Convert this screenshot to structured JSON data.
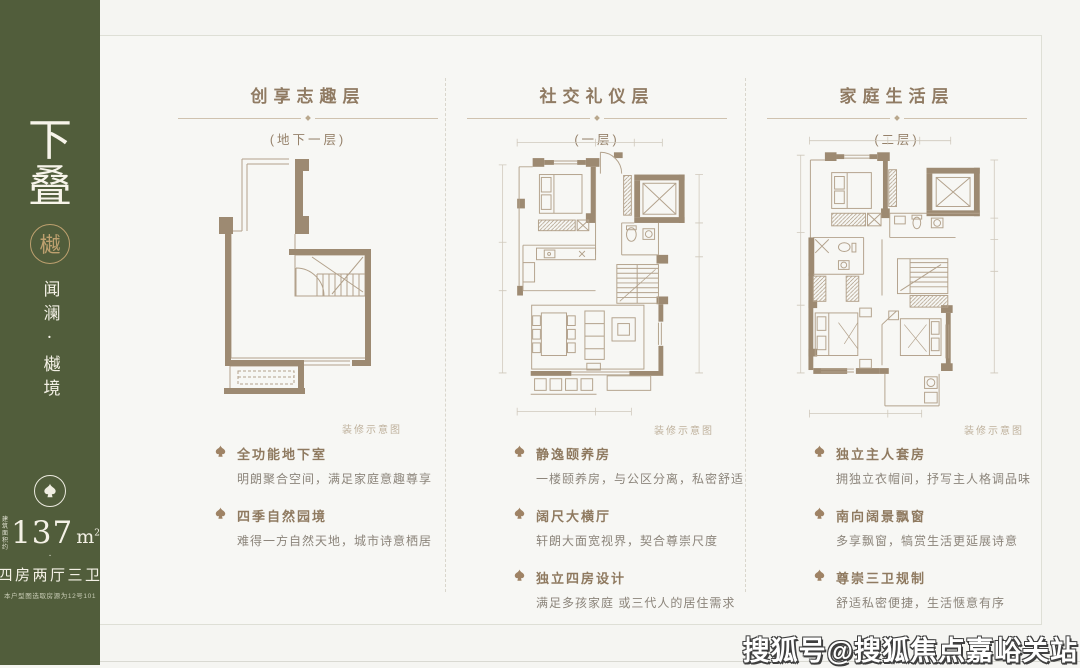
{
  "sidebar": {
    "title_char1": "下",
    "title_char2": "叠",
    "seal_char": "樾",
    "brand": "闻澜·樾境",
    "area_prefix_line1": "建筑",
    "area_prefix_line2": "面积约",
    "area_value": "137",
    "area_unit": "m",
    "area_power": "2",
    "separator_dot": "·",
    "layout_text": "四房两厅三卫",
    "note": "本户型图选取房源为12号101"
  },
  "columns": [
    {
      "title": "创享志趣层",
      "subtitle": "(地下一层)",
      "caption": "装修示意图",
      "bullets": [
        {
          "title": "全功能地下室",
          "desc": "明朗聚合空间，满足家庭意趣尊享"
        },
        {
          "title": "四季自然园境",
          "desc": "难得一方自然天地，城市诗意栖居"
        }
      ]
    },
    {
      "title": "社交礼仪层",
      "subtitle": "(一层)",
      "caption": "装修示意图",
      "bullets": [
        {
          "title": "静逸颐养房",
          "desc": "一楼颐养房，与公区分离，私密舒适"
        },
        {
          "title": "阔尺大横厅",
          "desc": "轩朗大面宽视界，契合尊崇尺度"
        },
        {
          "title": "独立四房设计",
          "desc": "满足多孩家庭 或三代人的居住需求"
        }
      ]
    },
    {
      "title": "家庭生活层",
      "subtitle": "(二层)",
      "caption": "装修示意图",
      "bullets": [
        {
          "title": "独立主人套房",
          "desc": "拥独立衣帽间，抒写主人格调品味"
        },
        {
          "title": "南向阔景飘窗",
          "desc": "多享飘窗，犒赏生活更延展诗意"
        },
        {
          "title": "尊崇三卫规制",
          "desc": "舒适私密便捷，生活惬意有序"
        }
      ]
    }
  ],
  "footer": {
    "watermark": "搜狐号@搜狐焦点嘉峪关站"
  },
  "colors": {
    "sidebar_green": "#515d3b",
    "seal_gold": "#bda06f",
    "heading_taupe": "#907b63",
    "plan_wall": "#9d8a72",
    "frame_border": "#dedfd6"
  }
}
